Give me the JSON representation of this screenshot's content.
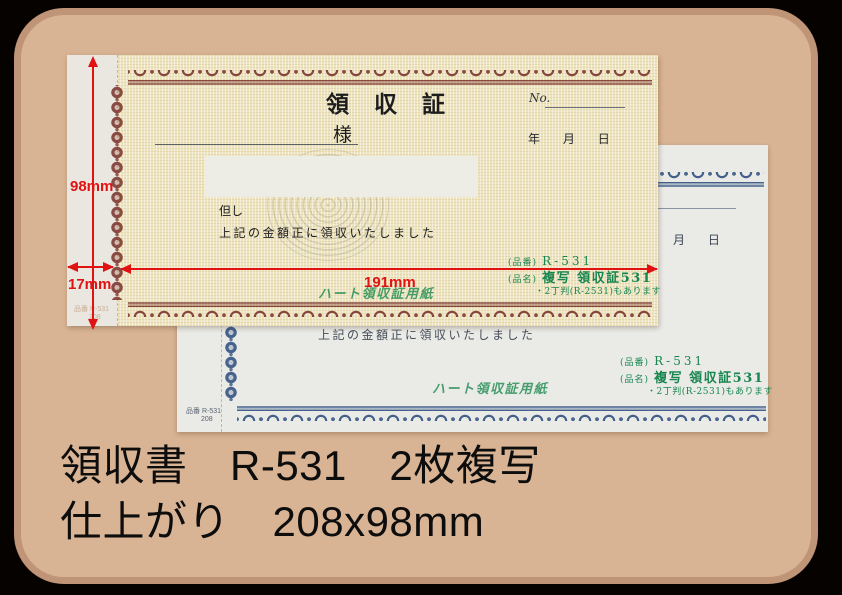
{
  "caption": {
    "line1": "領収書　R-531　2枚複写",
    "line2": "仕上がり　208x98mm"
  },
  "dimensions": {
    "height": "98mm",
    "stub_width": "17mm",
    "body_width": "191mm"
  },
  "front_sheet": {
    "title": "領収証",
    "no_label": "No.",
    "honorific": "様",
    "year_label": "年",
    "month_label": "月",
    "day_label": "日",
    "proviso": "但し",
    "statement": "上記の金額正に領収いたしました",
    "code_label": "(品番)",
    "code": "R-531",
    "name_label": "(品名)",
    "name": "複写 領収証531",
    "note": "・2丁判(R-2531)もあります",
    "brand": "ハート領収証用紙",
    "stub_code": "品番 R-531",
    "stub_size": "208"
  },
  "back_sheet": {
    "month_label": "月",
    "day_label": "日",
    "statement": "上記の金額正に領収いたしました",
    "code_label": "(品番)",
    "code": "R-531",
    "name_label": "(品名)",
    "name": "複写 領収証531",
    "note": "・2丁判(R-2531)もあります",
    "brand": "ハート領収証用紙",
    "stub_code": "品番 R-531",
    "stub_size": "208"
  },
  "colors": {
    "background": "#050200",
    "frame_fill": "#d9b494",
    "frame_border": "#bf9477",
    "front_paper": "#ede4c1",
    "front_stub": "#e9e7e0",
    "front_ornament": "#823e37",
    "back_paper": "#eaebe7",
    "back_ornament": "#3a5886",
    "product_green": "#17854f",
    "annotation_red": "#e01212"
  }
}
